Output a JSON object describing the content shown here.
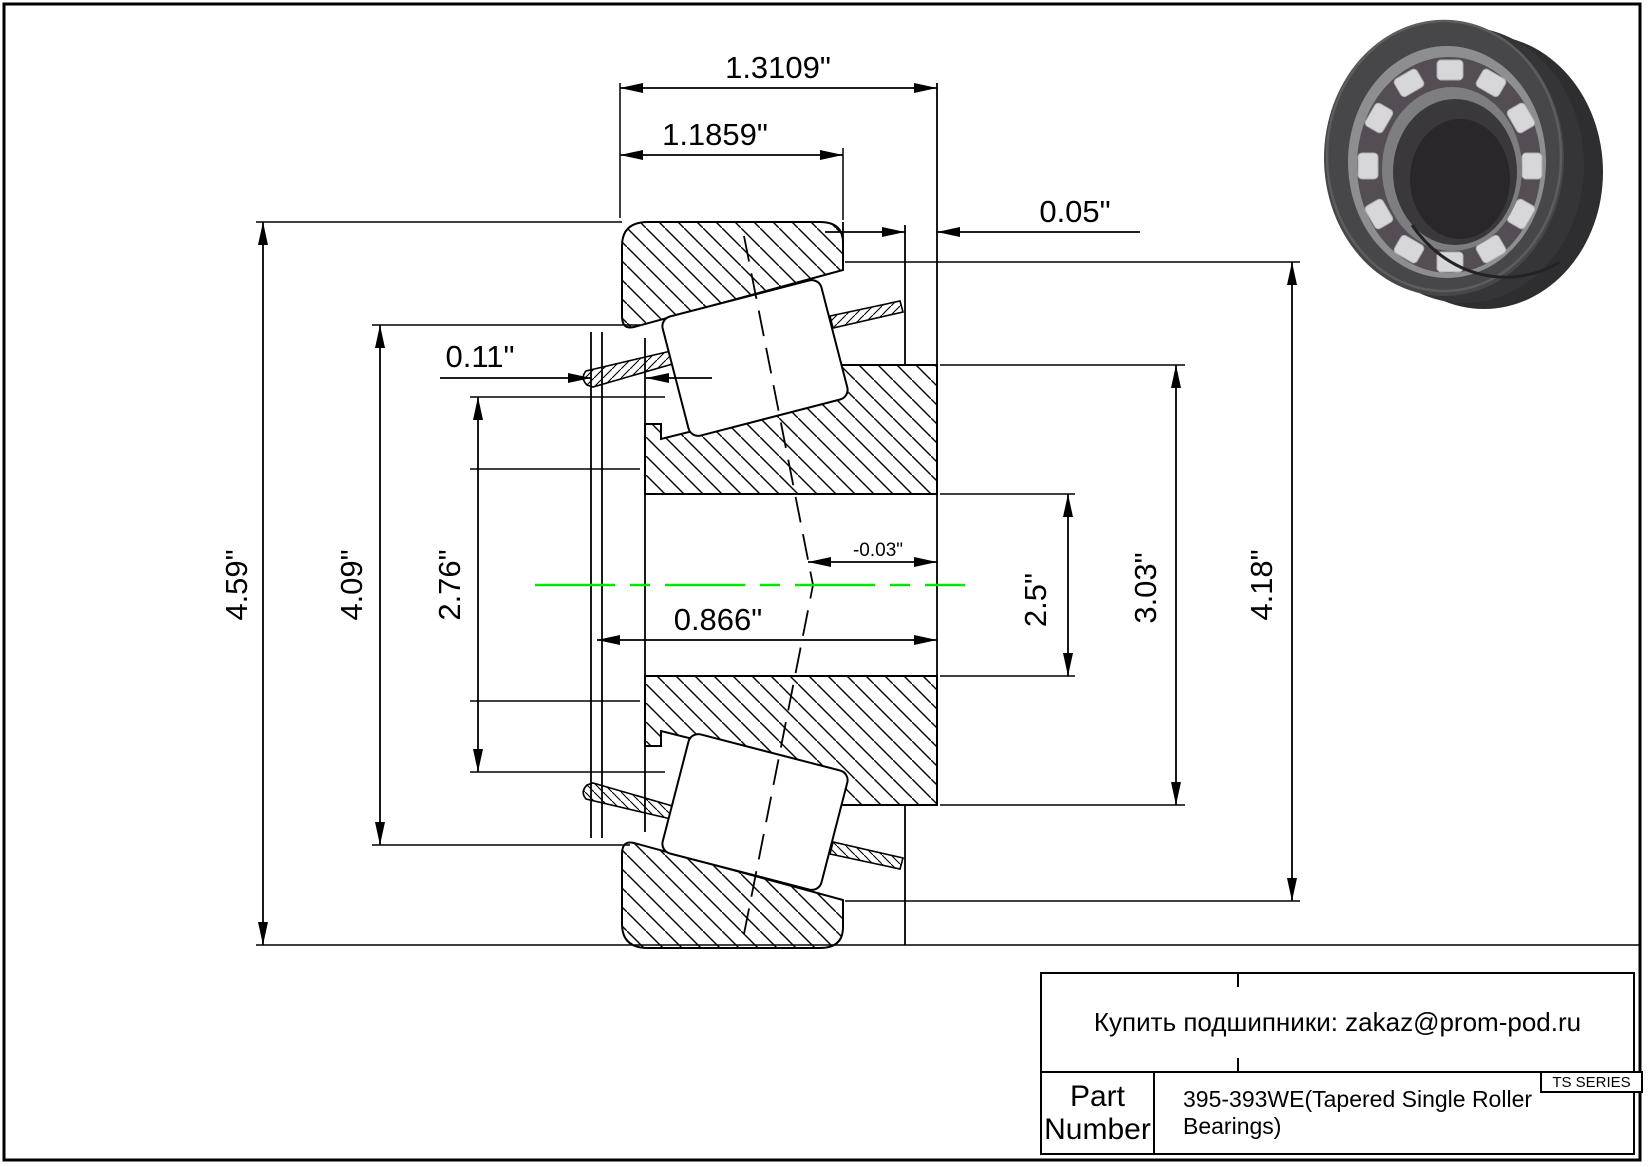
{
  "drawing": {
    "centerline_color": "#00e600",
    "line_color": "#000000",
    "dims": {
      "overall_width": "1.3109\"",
      "cup_width": "1.1859\"",
      "back_standout": "0.05\"",
      "front_standout": "0.11\"",
      "outer_diameter": "4.59\"",
      "flange_diameter": "4.09\"",
      "rib_diameter": "2.76\"",
      "cone_width": "0.866\"",
      "axial_offset": "-0.03\"",
      "bore_diameter": "2.5\"",
      "cone_back_diameter": "3.03\"",
      "cup_diameter": "4.18\""
    }
  },
  "title_block": {
    "contact_line": "Купить подшипники: zakaz@prom-pod.ru",
    "series_badge": "TS SERIES",
    "part_label_line1": "Part",
    "part_label_line2": "Number",
    "part_number": "395-393WE(Tapered Single Roller Bearings)"
  }
}
